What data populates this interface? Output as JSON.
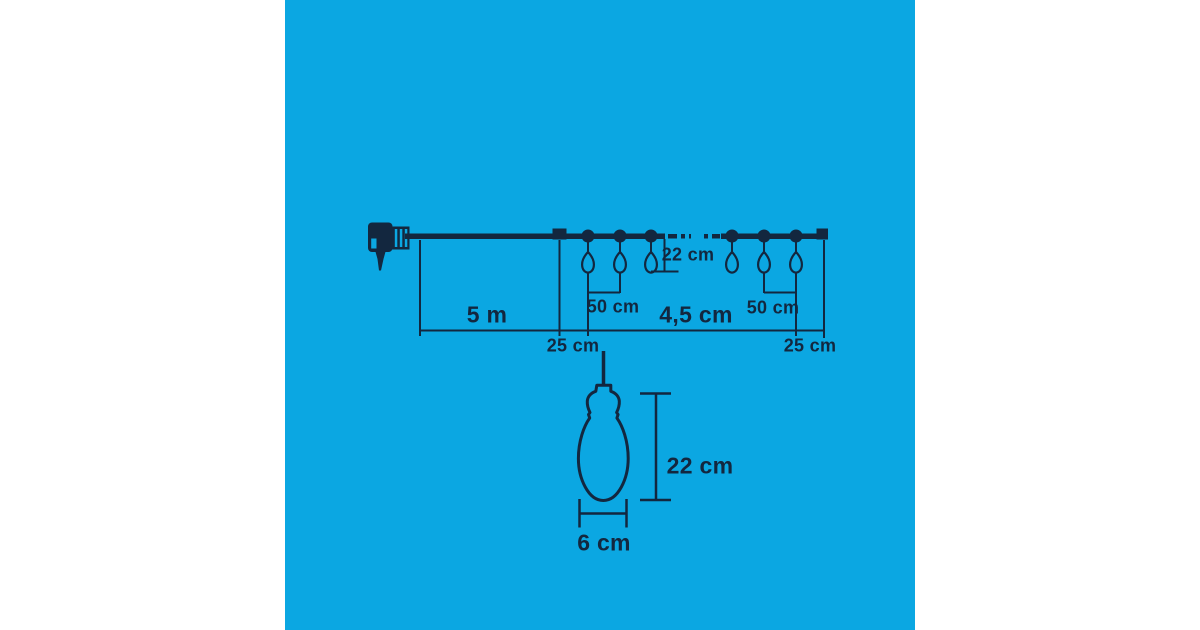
{
  "colors": {
    "background": "#ffffff",
    "panel": "#0ba7e2",
    "ink": "#13273f"
  },
  "diagram": {
    "title_hidden": "",
    "dimensions": {
      "lead": "5 m",
      "total": "4,5 cm",
      "offset_start": "25 cm",
      "offset_end": "25 cm",
      "spacing_a": "50 cm",
      "spacing_b": "50 cm",
      "drop": "22 cm"
    },
    "bulb_detail": {
      "height": "22 cm",
      "width": "6 cm"
    },
    "icons": {
      "plug": "power-plug-icon",
      "socket": "socket-dot-icon",
      "bulb": "drop-bulb-icon",
      "bulb_detail": "bulb-detail-icon"
    }
  }
}
